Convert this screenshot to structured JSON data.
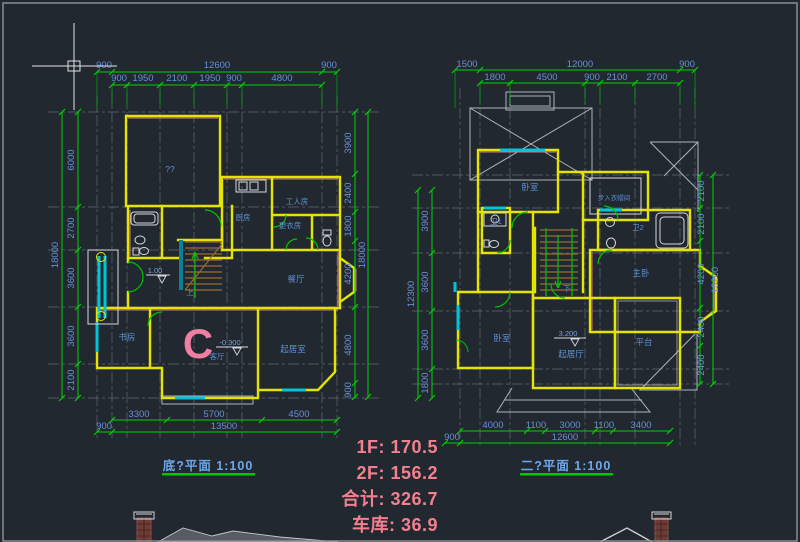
{
  "app": {
    "bg": "#212830",
    "border": "#878d96",
    "accent_green": "#00d400",
    "dim_text": "#6b8fd4",
    "wall_yellow": "#e4e400",
    "window_cyan": "#00c4d8",
    "stats_pink": "#f2808e"
  },
  "p1": {
    "title": "底?平面  1:100",
    "t1": [
      "900",
      "12600",
      "900"
    ],
    "t2": [
      "900",
      "1950",
      "2100",
      "1950",
      "900",
      "4800"
    ],
    "left": [
      "6000",
      "2700",
      "3600",
      "3600",
      "2100"
    ],
    "left_total": "18000",
    "right": [
      "3900",
      "2400",
      "1800",
      "4200",
      "4800",
      "900"
    ],
    "right_total": "18000",
    "b1": [
      "3300",
      "5700",
      "4500"
    ],
    "b2": [
      "900",
      "13500"
    ],
    "rooms": {
      "garage": "??",
      "kitchen": "厨房",
      "worker": "工人房",
      "laundry": "更衣房",
      "dining": "餐厅",
      "study": "书房",
      "living": "客厅",
      "sitting": "起居室",
      "up": "上",
      "mark_c": "C",
      "lv_entry": "1.00",
      "lv_living": "-0.300"
    }
  },
  "p2": {
    "title": "二?平面  1:100",
    "t1": [
      "1500",
      "12000",
      "900"
    ],
    "t2": [
      "1800",
      "4500",
      "900",
      "2100",
      "2700"
    ],
    "left": [
      "3900",
      "3600",
      "3600",
      "1800"
    ],
    "left_total": "12300",
    "right": [
      "2100",
      "2100",
      "4200",
      "2400",
      "2400"
    ],
    "right_total": "13200",
    "b1": [
      "4000",
      "1100",
      "3000",
      "1100",
      "3400"
    ],
    "b2": [
      "900",
      "12600"
    ],
    "rooms": {
      "bed1": "卧室",
      "closet": "步入衣帽间",
      "bath1": "卫1",
      "bath2": "卫2",
      "master": "主卧",
      "bed2": "卧室",
      "sitting": "起居厅",
      "terrace": "平台",
      "down": "下",
      "lv": "3.200"
    }
  },
  "stats": {
    "lines": [
      "1F: 170.5",
      "2F: 156.2",
      "合计: 326.7",
      "车库:  36.9"
    ]
  }
}
